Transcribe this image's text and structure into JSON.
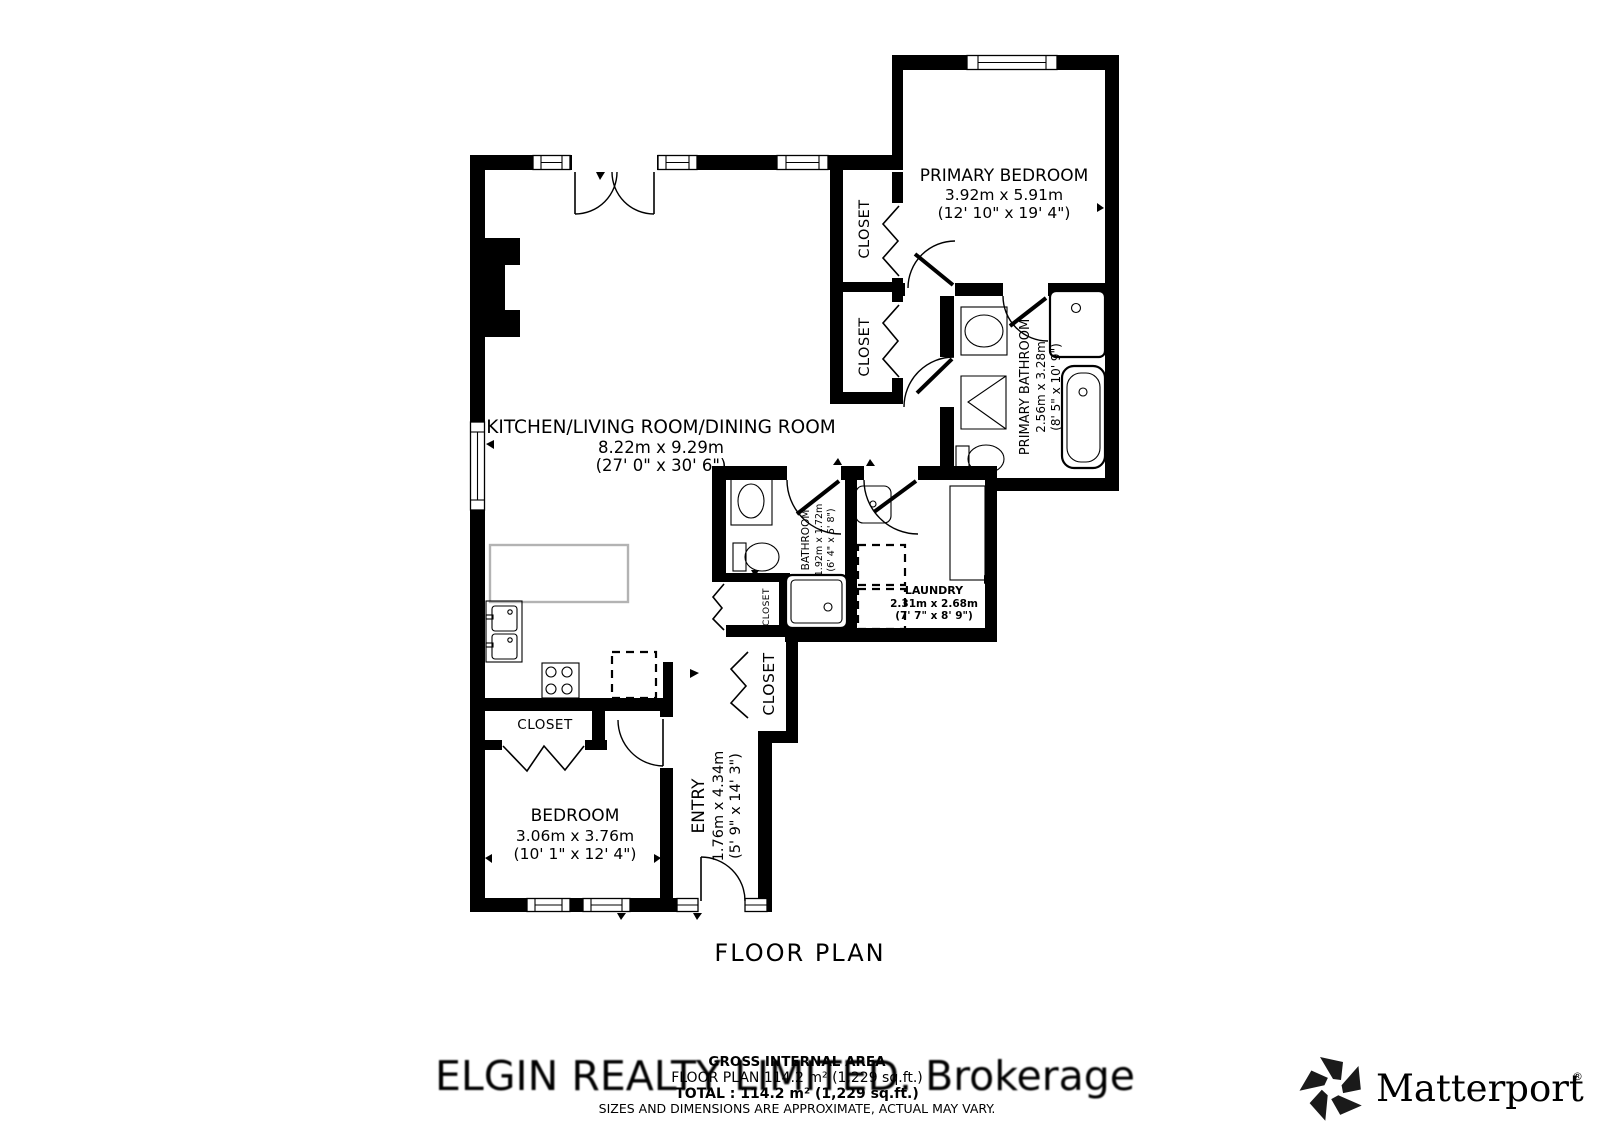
{
  "plan": {
    "title": "FLOOR PLAN",
    "closet_label": "CLOSET",
    "rooms": {
      "living": {
        "name": "KITCHEN/LIVING ROOM/DINING ROOM",
        "metric": "8.22m x 9.29m",
        "imperial": "(27' 0\" x 30' 6\")"
      },
      "primary_bedroom": {
        "name": "PRIMARY BEDROOM",
        "metric": "3.92m x 5.91m",
        "imperial": "(12' 10\" x 19' 4\")"
      },
      "primary_bathroom": {
        "name": "PRIMARY BATHROOM",
        "metric": "2.56m x 3.28m",
        "imperial": "(8' 5\" x 10' 9\")"
      },
      "bathroom": {
        "name": "BATHROOM",
        "metric": "1.92m x 1.72m",
        "imperial": "(6' 4\" x 5' 8\")"
      },
      "laundry": {
        "name": "LAUNDRY",
        "metric": "2.31m x 2.68m",
        "imperial": "(7' 7\" x 8' 9\")"
      },
      "bedroom": {
        "name": "BEDROOM",
        "metric": "3.06m x 3.76m",
        "imperial": "(10' 1\" x 12' 4\")"
      },
      "entry": {
        "name": "ENTRY",
        "metric": "1.76m x 4.34m",
        "imperial": "(5' 9\" x 14' 3\")"
      }
    }
  },
  "footer": {
    "gross_internal_area": "GROSS INTERNAL AREA",
    "floor_plan_area": "FLOOR PLAN 114.2 m² (1,229 sq.ft.)",
    "total_area": "TOTAL :  114.2 m² (1,229 sq.ft.)",
    "disclaimer": "SIZES AND DIMENSIONS ARE APPROXIMATE, ACTUAL MAY VARY."
  },
  "watermark": "ELGIN REALTY LIMITED. Brokerage",
  "branding": {
    "name": "Matterport",
    "registered": "®"
  },
  "colors": {
    "wall": "#000000",
    "background": "#ffffff",
    "watermark": "#d8d8d8",
    "disclaimer_text": "#4d4d4d",
    "counter_outline": "#b3b3b3"
  }
}
